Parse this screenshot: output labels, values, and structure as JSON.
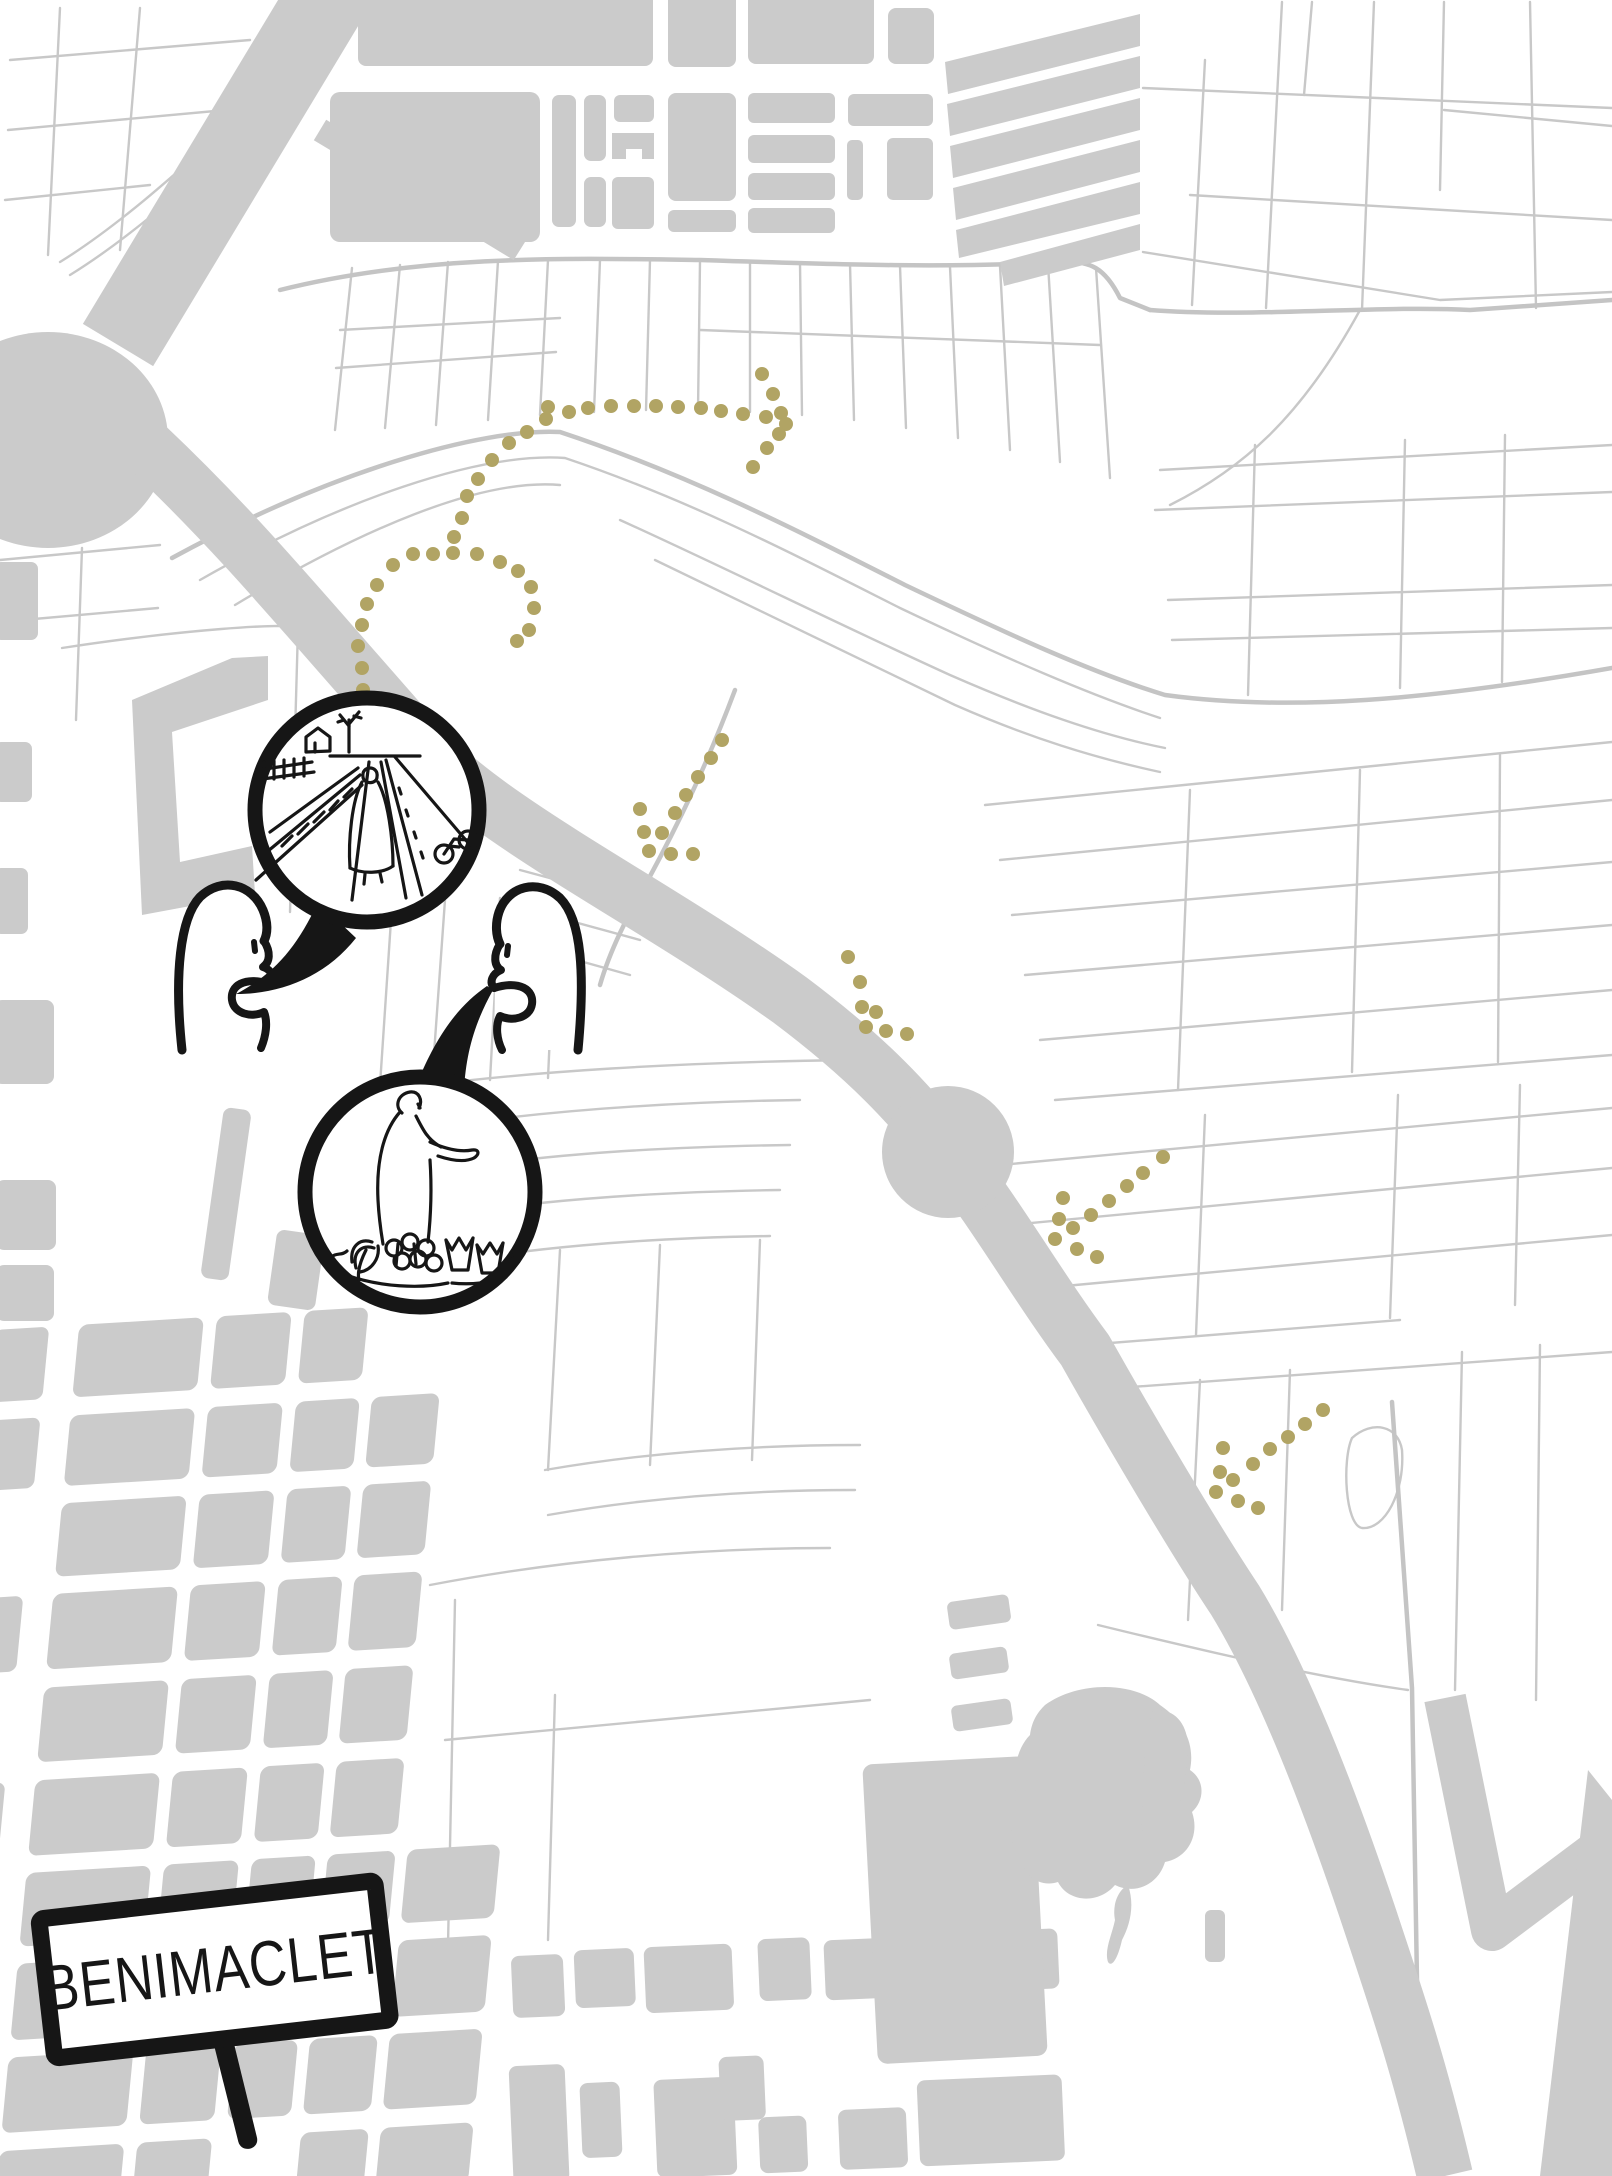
{
  "map": {
    "place_label": "BENIMACLET",
    "description": "Stylized black-and-white map of the Benimaclet neighbourhood and its orchard (huerta) fields, with dotted walking trails and a hand-drawn comic conversation"
  },
  "sign": {
    "label": "BENIMACLET"
  },
  "colors": {
    "background": "#ffffff",
    "urban_block": "#cbcbcb",
    "parcel_line": "#c8c8c8",
    "thin_road": "#c4c4c4",
    "trail": "#b1a464",
    "ink": "#161616"
  },
  "trail": {
    "dot_radius": 7,
    "clusters": [
      {
        "name": "trail-top-row",
        "points": [
          [
            548,
            407
          ],
          [
            569,
            412
          ],
          [
            588,
            408
          ],
          [
            611,
            406
          ],
          [
            634,
            406
          ],
          [
            656,
            406
          ],
          [
            678,
            407
          ],
          [
            701,
            408
          ],
          [
            721,
            411
          ],
          [
            743,
            414
          ]
        ]
      },
      {
        "name": "trail-top-hook",
        "points": [
          [
            762,
            374
          ],
          [
            773,
            394
          ],
          [
            766,
            417
          ],
          [
            781,
            413
          ],
          [
            786,
            424
          ],
          [
            779,
            434
          ],
          [
            767,
            448
          ],
          [
            753,
            467
          ]
        ]
      },
      {
        "name": "trail-top-curve",
        "points": [
          [
            546,
            419
          ],
          [
            527,
            432
          ],
          [
            509,
            443
          ],
          [
            492,
            460
          ],
          [
            478,
            479
          ],
          [
            467,
            496
          ],
          [
            462,
            518
          ],
          [
            454,
            537
          ],
          [
            453,
            553
          ]
        ]
      },
      {
        "name": "trail-left-branch",
        "points": [
          [
            433,
            554
          ],
          [
            413,
            554
          ],
          [
            393,
            565
          ],
          [
            377,
            585
          ],
          [
            367,
            604
          ],
          [
            362,
            625
          ],
          [
            358,
            646
          ],
          [
            362,
            668
          ],
          [
            363,
            690
          ]
        ]
      },
      {
        "name": "trail-right-branch",
        "points": [
          [
            477,
            554
          ],
          [
            500,
            562
          ],
          [
            518,
            571
          ],
          [
            531,
            587
          ],
          [
            534,
            608
          ],
          [
            529,
            630
          ],
          [
            517,
            641
          ]
        ]
      },
      {
        "name": "trail-mid-descent",
        "points": [
          [
            722,
            740
          ],
          [
            711,
            758
          ],
          [
            698,
            777
          ],
          [
            686,
            795
          ],
          [
            675,
            813
          ],
          [
            640,
            809
          ],
          [
            644,
            832
          ],
          [
            662,
            833
          ],
          [
            649,
            851
          ],
          [
            671,
            854
          ],
          [
            693,
            854
          ]
        ]
      },
      {
        "name": "trail-mid-hook",
        "points": [
          [
            848,
            957
          ],
          [
            860,
            982
          ],
          [
            862,
            1007
          ],
          [
            876,
            1012
          ],
          [
            866,
            1027
          ],
          [
            886,
            1031
          ],
          [
            907,
            1034
          ]
        ]
      },
      {
        "name": "trail-east-of-roundabout",
        "points": [
          [
            1163,
            1157
          ],
          [
            1143,
            1173
          ],
          [
            1127,
            1186
          ],
          [
            1109,
            1201
          ],
          [
            1091,
            1215
          ],
          [
            1063,
            1198
          ],
          [
            1059,
            1219
          ],
          [
            1073,
            1228
          ],
          [
            1055,
            1239
          ],
          [
            1077,
            1249
          ],
          [
            1097,
            1257
          ]
        ]
      },
      {
        "name": "trail-southeast",
        "points": [
          [
            1323,
            1410
          ],
          [
            1305,
            1424
          ],
          [
            1288,
            1437
          ],
          [
            1270,
            1449
          ],
          [
            1253,
            1464
          ],
          [
            1223,
            1448
          ],
          [
            1220,
            1472
          ],
          [
            1233,
            1480
          ],
          [
            1216,
            1492
          ],
          [
            1238,
            1501
          ],
          [
            1258,
            1508
          ]
        ]
      }
    ]
  },
  "illustration": {
    "figures": [
      {
        "name": "left-figure",
        "description": "doodle person facing right, talking"
      },
      {
        "name": "right-figure",
        "description": "doodle person facing left, talking"
      }
    ],
    "speech_bubbles": [
      {
        "name": "huerta-path-scene",
        "description": "sketch of a person walking a straight path between crop fields with farmhouse, tree and cyclist"
      },
      {
        "name": "market-produce-scene",
        "description": "sketch of a person at a stall with fruit, bananas and paper cones of produce"
      }
    ]
  }
}
